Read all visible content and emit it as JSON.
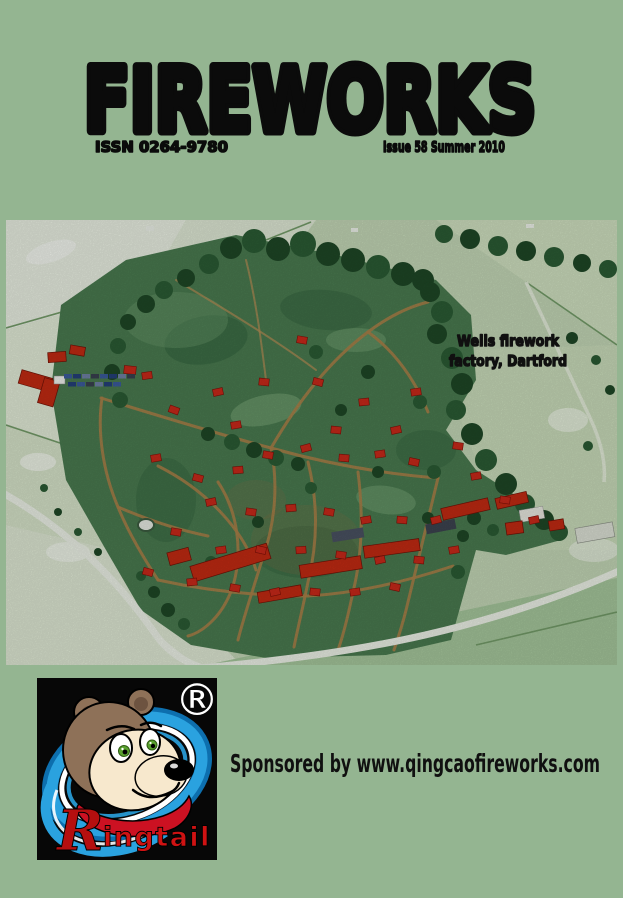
{
  "page": {
    "background_color": "#94b591"
  },
  "masthead": {
    "title": "FIREWORKS",
    "issn": "ISSN 0264-9780",
    "issue": "Issue 58 Summer 2010"
  },
  "cover_photo": {
    "caption_line1": "Wells firework",
    "caption_line2": "factory, Dartford"
  },
  "sponsor": {
    "text": "Sponsored by www.qingcaofireworks.com"
  },
  "logo": {
    "registered_mark": "®",
    "wordmark_initial": "R",
    "wordmark_rest": "ingtail"
  },
  "colors": {
    "background_green": "#94b591",
    "roof_red": "#c9291a",
    "logo_blue": "#2aa2df",
    "wordmark_red": "#cf1212"
  }
}
